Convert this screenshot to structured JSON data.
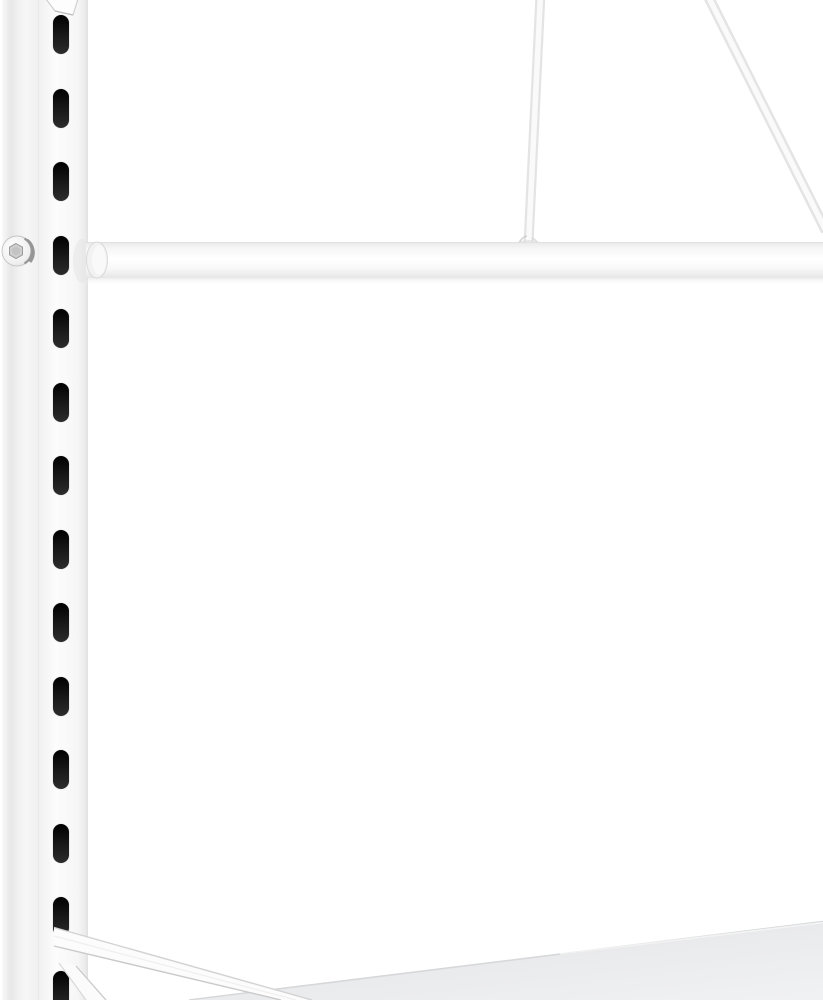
{
  "meta": {
    "type": "product-photo",
    "description": "Close-up of the lower-front corner of a white metal boltless shelving rack: a slotted upright post on the left, a horizontal hang rail, two diagonal brace rods at the top right, a diagonal shelf bracket at the bottom left and a light-gray shelf surface at the bottom right, all on a pure white background",
    "background_color": "#ffffff",
    "text_content": "none"
  },
  "scene": {
    "upright_post": {
      "name": "slotted upright post",
      "face_color": "#f7f7f7",
      "side_shade_color": "#e7e7e7",
      "edge_color": "#dcdcdc",
      "slots": {
        "count": 14,
        "color": "#1a1a1a",
        "x": 53,
        "width": 16,
        "height": 39,
        "first_top": 15,
        "pitch": 73.5
      },
      "screw": {
        "cx": 17,
        "cy": 251,
        "r": 15,
        "head_color": "#f2f2f2",
        "rim_color": "#8d8d8d",
        "socket_color": "#cfcfcf"
      },
      "top_hook": {
        "name": "beam hook tab",
        "color": "#fdfdfd",
        "edge_color": "#cdcdcd"
      }
    },
    "hang_rail": {
      "name": "horizontal round rail",
      "top": 242,
      "bottom": 278,
      "left": 86,
      "right": 823,
      "color": "#fbfbfb",
      "edge_color": "#e2e2e2",
      "cap_color": "#f2f2f2"
    },
    "brace_rods": {
      "vertical_rod": {
        "x_top": 540,
        "y_top": 0,
        "x_bottom": 529,
        "y_bottom": 243,
        "thickness": 10
      },
      "diagonal_rod": {
        "x_top": 707,
        "y_top": 0,
        "x_exit": 826,
        "y_exit": 231,
        "thickness": 10
      },
      "rod_color": "#e4e4e4",
      "rod_highlight": "#fafafa",
      "joint_shadow_color": "#d9d9d9"
    },
    "shelf_bracket": {
      "name": "diagonal shelf bracket",
      "attach_point": {
        "x": 54,
        "y": 928
      },
      "end_x_at_bottom": 312,
      "color": "#fcfcfc",
      "edge_color": "#cfcfcf"
    },
    "lower_strut": {
      "name": "short steep strut",
      "color": "#fbfbfb",
      "edge_color": "#d5d5d5"
    },
    "shelf": {
      "name": "shelf surface",
      "edge_from": {
        "x": 189,
        "y": 1000
      },
      "edge_to": {
        "x": 823,
        "y": 921
      },
      "surface_color": "#e8e9eb",
      "deep_color": "#f0f1f2",
      "edge_line_color": "#d6d7d9"
    }
  }
}
